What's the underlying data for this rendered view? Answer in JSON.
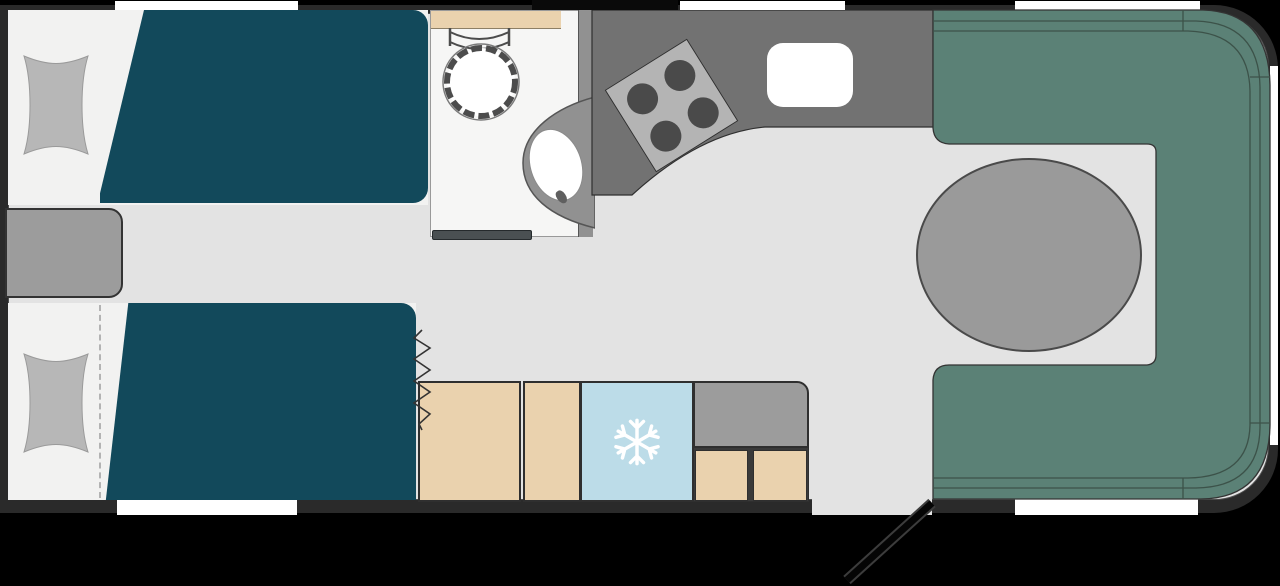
{
  "title": "caravan-twin-bed-floorplan",
  "colors": {
    "bg": "#000000",
    "wall": "#2a2a2a",
    "floor": "#e3e3e3",
    "window": "#ffffff",
    "bed_duvet": "#12495b",
    "bed_base": "#f2f2f1",
    "pillow": "#b7b7b7",
    "unit_gray": "#9c9c9c",
    "unit_mid": "#919191",
    "table_gray": "#9a9a9a",
    "lounge": "#5b8176",
    "lounge_line": "#3c5249",
    "counter": "#727272",
    "hob": "#b4b4b4",
    "burner": "#4a4a4a",
    "beige": "#ead2ae",
    "fridge": "#bcdce8",
    "bathroom": "#f6f6f5",
    "door_strip": "#4a5052"
  },
  "plan": {
    "type": "caravan floor plan, top view, no text labels",
    "zones": [
      {
        "name": "twin-bedroom",
        "items": [
          "single-bed-top",
          "single-bed-bottom",
          "pillow x2",
          "bedside-chest"
        ]
      },
      {
        "name": "washroom",
        "items": [
          "shower",
          "toilet",
          "shelf"
        ]
      },
      {
        "name": "kitchen",
        "items": [
          "worktop",
          "hob-4-burners",
          "sink",
          "wardrobe",
          "fridge",
          "drawer-unit"
        ]
      },
      {
        "name": "front-lounge",
        "items": [
          "u-shaped-seating",
          "oval-table"
        ]
      },
      {
        "name": "entrance",
        "items": [
          "door-swing-line",
          "door-opening"
        ]
      }
    ],
    "windows": [
      "top-left",
      "top-middle",
      "top-right",
      "bottom-left",
      "bottom-right",
      "front-right"
    ],
    "icons": {
      "fridge": "snowflake-icon"
    }
  }
}
